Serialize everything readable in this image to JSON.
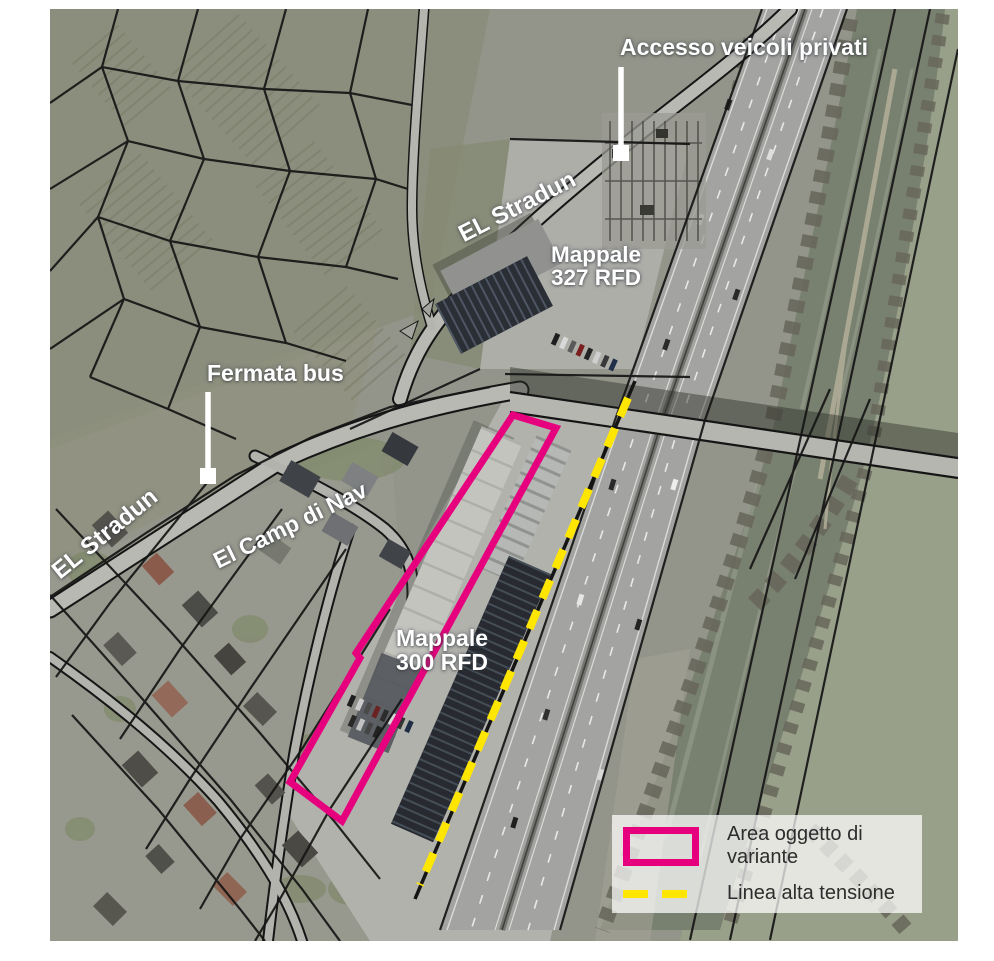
{
  "annotations": {
    "access_label": "Accesso veicoli privati",
    "bus_stop_label": "Fermata bus",
    "parcel_327": {
      "line1": "Mappale",
      "line2": "327 RFD"
    },
    "parcel_300": {
      "line1": "Mappale",
      "line2": "300 RFD"
    },
    "street_el_stradun_upper": "EL Stradun",
    "street_el_stradun_lower": "EL Stradun",
    "street_el_camp_di_nav": "El Camp di Nav"
  },
  "legend": {
    "items": [
      {
        "swatch": "magenta-rectangle-outline",
        "label": "Area oggetto di variante"
      },
      {
        "swatch": "yellow-dashed-line",
        "label": "Linea alta tensione"
      }
    ]
  },
  "markers": [
    {
      "name": "access-point-marker",
      "shape": "white-square"
    },
    {
      "name": "bus-stop-marker",
      "shape": "white-square"
    }
  ],
  "colors": {
    "variant_area_outline": "#e6007e",
    "high_voltage_line": "#ffe600",
    "annotation_text": "#ffffff",
    "legend_text": "#2d2d2d",
    "cadastral_line": "#151515"
  }
}
